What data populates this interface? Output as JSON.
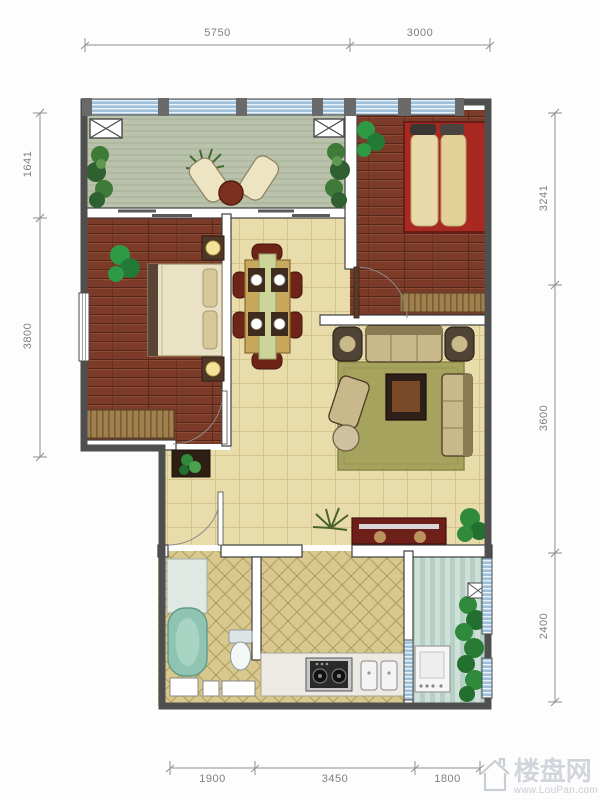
{
  "dimensions": {
    "top": [
      "5750",
      "3000"
    ],
    "left": [
      "1641",
      "3800"
    ],
    "right": [
      "3241",
      "3600",
      "2400"
    ],
    "bottom": [
      "1900",
      "3450",
      "1800"
    ]
  },
  "watermark": {
    "site_name": "楼盘网",
    "site_url": "www.LouPan.com"
  },
  "colors": {
    "exterior_wall": "#4f4f4f",
    "wood_floor": "#7c3b28",
    "tile_floor": "#e9dcab",
    "kitchen_bath_tile": "#d9c88e",
    "balcony_floor": "#bac2ac",
    "utility_floor": "#cfe0d8",
    "window_glass": "#9fc0da",
    "bed_red": "#a82822",
    "rug_olive": "#a6a35f",
    "dimension_text": "#7f7f7f",
    "watermark_gray": "#d2d5db"
  }
}
